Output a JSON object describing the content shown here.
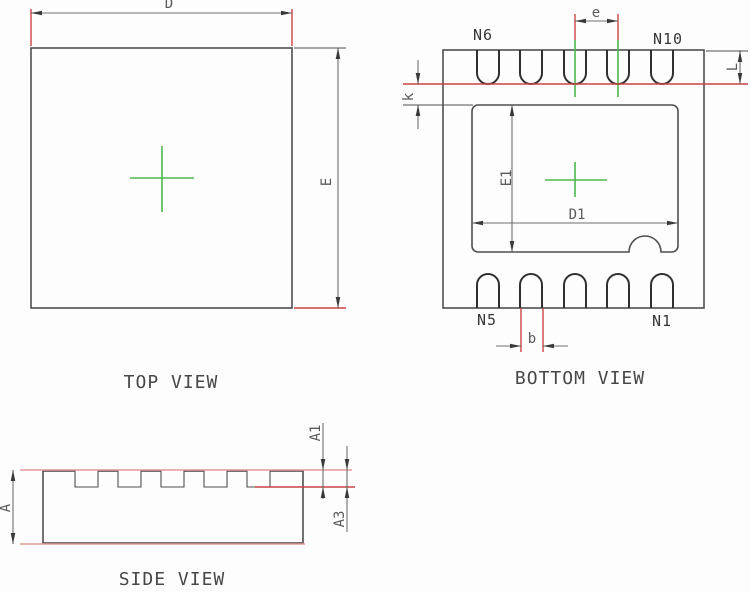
{
  "colors": {
    "background": "#fdfdfd",
    "outline": "#4f4f4f",
    "pad_outline": "#303030",
    "dimension": "#6f6f6f",
    "arrow": "#3a3a3a",
    "red": "#cc4343",
    "pink": "#e59a9a",
    "green": "#4db84d",
    "label": "#5a5a5a",
    "pin_label": "#363636",
    "title_text": "#474747"
  },
  "views": {
    "top": {
      "title": "TOP VIEW",
      "dim_d": "D",
      "dim_e": "E"
    },
    "bottom": {
      "title": "BOTTOM VIEW",
      "pin_top_left": "N6",
      "pin_top_right": "N10",
      "pin_bottom_left": "N5",
      "pin_bottom_right": "N1",
      "dim_pitch": "e",
      "dim_lead_length": "L",
      "dim_k": "k",
      "dim_e1": "E1",
      "dim_d1": "D1",
      "dim_b": "b"
    },
    "side": {
      "title": "SIDE VIEW",
      "dim_a": "A",
      "dim_a1": "A1",
      "dim_a3": "A3"
    }
  }
}
